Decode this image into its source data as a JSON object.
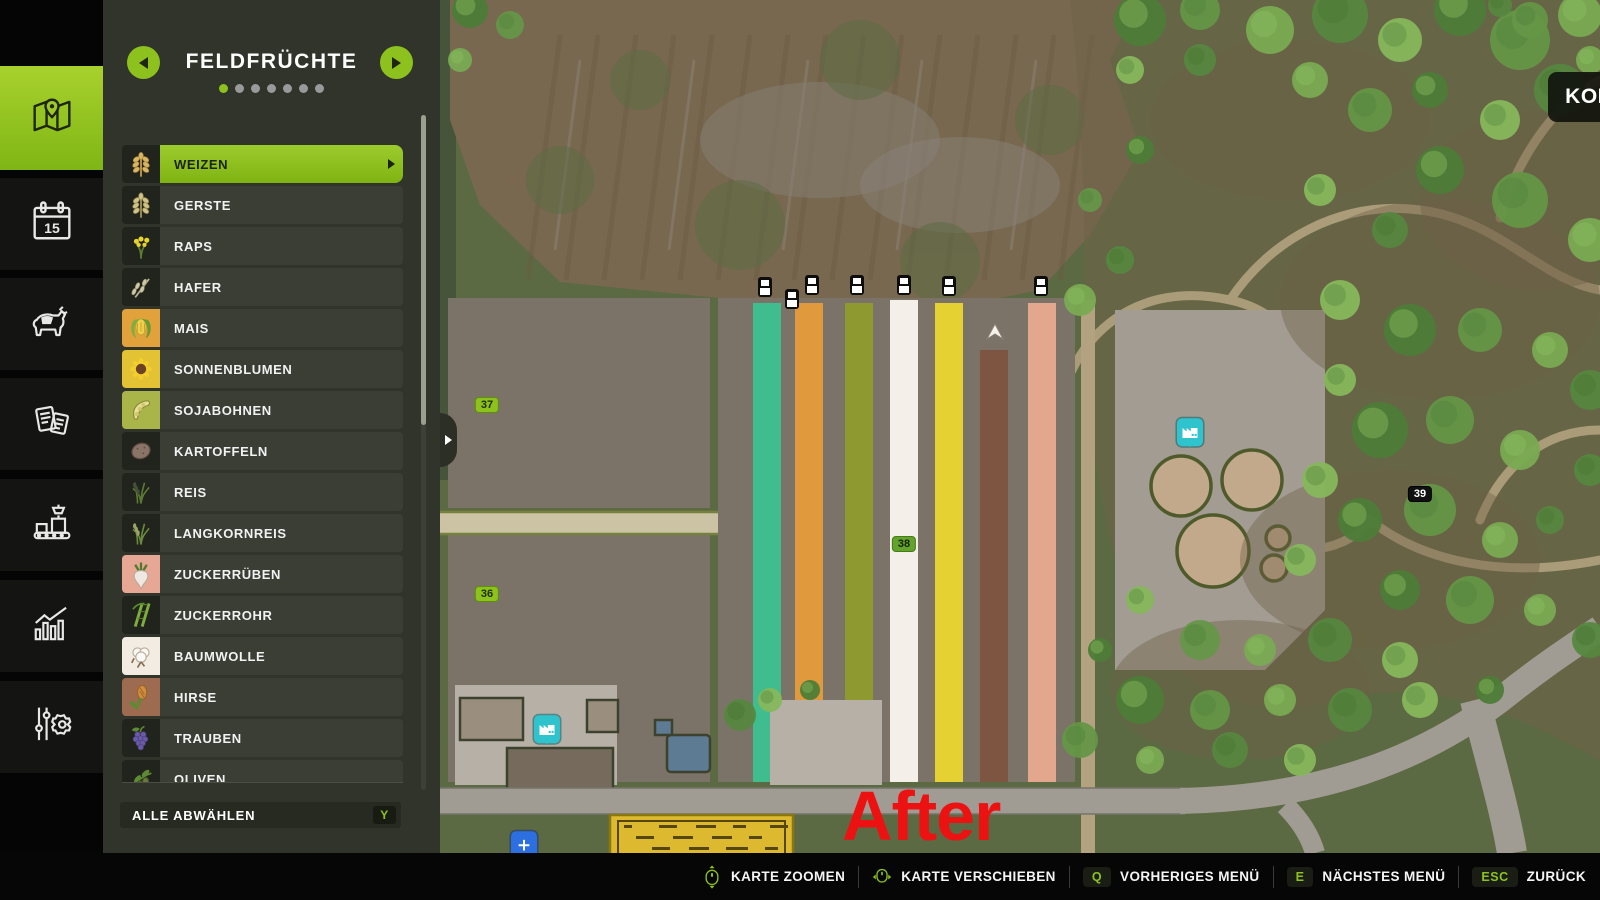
{
  "colors": {
    "accent": "#8dc21e",
    "panel_bg": "#30342b",
    "row_bg": "#3a3e35",
    "hotbar_bg": "#060606"
  },
  "sidebar": {
    "items": [
      {
        "name": "map",
        "icon": "map-icon",
        "active": true
      },
      {
        "name": "calendar",
        "icon": "calendar-icon",
        "active": false
      },
      {
        "name": "animals",
        "icon": "animals-icon",
        "active": false
      },
      {
        "name": "contracts",
        "icon": "contracts-icon",
        "active": false
      },
      {
        "name": "production",
        "icon": "production-icon",
        "active": false
      },
      {
        "name": "statistics",
        "icon": "statistics-icon",
        "active": false
      },
      {
        "name": "settings",
        "icon": "settings-icon",
        "active": false
      }
    ]
  },
  "panel": {
    "title": "FELDFRÜCHTE",
    "page_dots": {
      "count": 7,
      "active_index": 0
    },
    "crops": [
      {
        "label": "WEIZEN",
        "icon": "wheat-icon",
        "tile": "#20241c",
        "selected": true
      },
      {
        "label": "GERSTE",
        "icon": "barley-icon",
        "tile": "#20241c",
        "selected": false
      },
      {
        "label": "RAPS",
        "icon": "canola-icon",
        "tile": "#20241c",
        "selected": false
      },
      {
        "label": "HAFER",
        "icon": "oat-icon",
        "tile": "#20241c",
        "selected": false
      },
      {
        "label": "MAIS",
        "icon": "corn-icon",
        "tile": "#e2a23b",
        "selected": false
      },
      {
        "label": "SONNENBLUMEN",
        "icon": "sunflower-icon",
        "tile": "#e3c233",
        "selected": false
      },
      {
        "label": "SOJABOHNEN",
        "icon": "soybean-icon",
        "tile": "#a9b449",
        "selected": false
      },
      {
        "label": "KARTOFFELN",
        "icon": "potato-icon",
        "tile": "#20241c",
        "selected": false
      },
      {
        "label": "REIS",
        "icon": "rice-icon",
        "tile": "#20241c",
        "selected": false
      },
      {
        "label": "LANGKORNREIS",
        "icon": "long-grain-rice-icon",
        "tile": "#20241c",
        "selected": false
      },
      {
        "label": "ZUCKERRÜBEN",
        "icon": "sugar-beet-icon",
        "tile": "#e7a795",
        "selected": false
      },
      {
        "label": "ZUCKERROHR",
        "icon": "sugarcane-icon",
        "tile": "#20241c",
        "selected": false
      },
      {
        "label": "BAUMWOLLE",
        "icon": "cotton-icon",
        "tile": "#f2ece3",
        "selected": false
      },
      {
        "label": "HIRSE",
        "icon": "millet-icon",
        "tile": "#9c6b50",
        "selected": false
      },
      {
        "label": "TRAUBEN",
        "icon": "grapes-icon",
        "tile": "#20241c",
        "selected": false
      },
      {
        "label": "OLIVEN",
        "icon": "olive-icon",
        "tile": "#20241c",
        "selected": false
      }
    ],
    "deselect_all": {
      "label": "ALLE ABWÄHLEN",
      "key": "Y"
    }
  },
  "map": {
    "balance": {
      "label": "KONTOSTAND:",
      "value": "1.000.000 €"
    },
    "field_badges": [
      {
        "label": "37",
        "x": 487,
        "y": 405,
        "variant": "green"
      },
      {
        "label": "36",
        "x": 487,
        "y": 594,
        "variant": "green"
      },
      {
        "label": "38",
        "x": 904,
        "y": 544,
        "variant": "dark-green"
      },
      {
        "label": "39",
        "x": 1420,
        "y": 494,
        "variant": "black"
      }
    ],
    "crop_strips": [
      {
        "x": 753,
        "color": "#40bd8e",
        "y_top": 303
      },
      {
        "x": 795,
        "color": "#e0993d",
        "y_top": 303
      },
      {
        "x": 845,
        "color": "#8e9a2f",
        "y_top": 303
      },
      {
        "x": 890,
        "color": "#f4efe8",
        "y_top": 300
      },
      {
        "x": 935,
        "color": "#e6d133",
        "y_top": 303
      },
      {
        "x": 980,
        "color": "#7e5540",
        "y_top": 350
      },
      {
        "x": 1028,
        "color": "#e3a78e",
        "y_top": 303
      }
    ],
    "vehicle_markers": [
      {
        "x": 765,
        "y": 287
      },
      {
        "x": 792,
        "y": 299
      },
      {
        "x": 812,
        "y": 285
      },
      {
        "x": 857,
        "y": 285
      },
      {
        "x": 904,
        "y": 285
      },
      {
        "x": 949,
        "y": 286
      },
      {
        "x": 1041,
        "y": 286
      }
    ],
    "points_of_interest": [
      {
        "icon": "production-point-icon",
        "x": 1190,
        "y": 435,
        "variant": "teal"
      },
      {
        "icon": "production-point-icon",
        "x": 547,
        "y": 732,
        "variant": "teal"
      },
      {
        "icon": "map-point-icon",
        "x": 524,
        "y": 848,
        "variant": "blue"
      }
    ],
    "player_marker": {
      "icon": "arrow-marker-icon",
      "x": 995,
      "y": 333
    }
  },
  "annotation": {
    "text": "After",
    "color": "#ec1212"
  },
  "hotbar": {
    "items": [
      {
        "icon": "mouse-scroll-icon",
        "label": "KARTE ZOOMEN"
      },
      {
        "icon": "mouse-drag-icon",
        "label": "KARTE VERSCHIEBEN"
      },
      {
        "key": "Q",
        "label": "VORHERIGES MENÜ"
      },
      {
        "key": "E",
        "label": "NÄCHSTES MENÜ"
      },
      {
        "key": "ESC",
        "label": "ZURÜCK"
      }
    ]
  }
}
